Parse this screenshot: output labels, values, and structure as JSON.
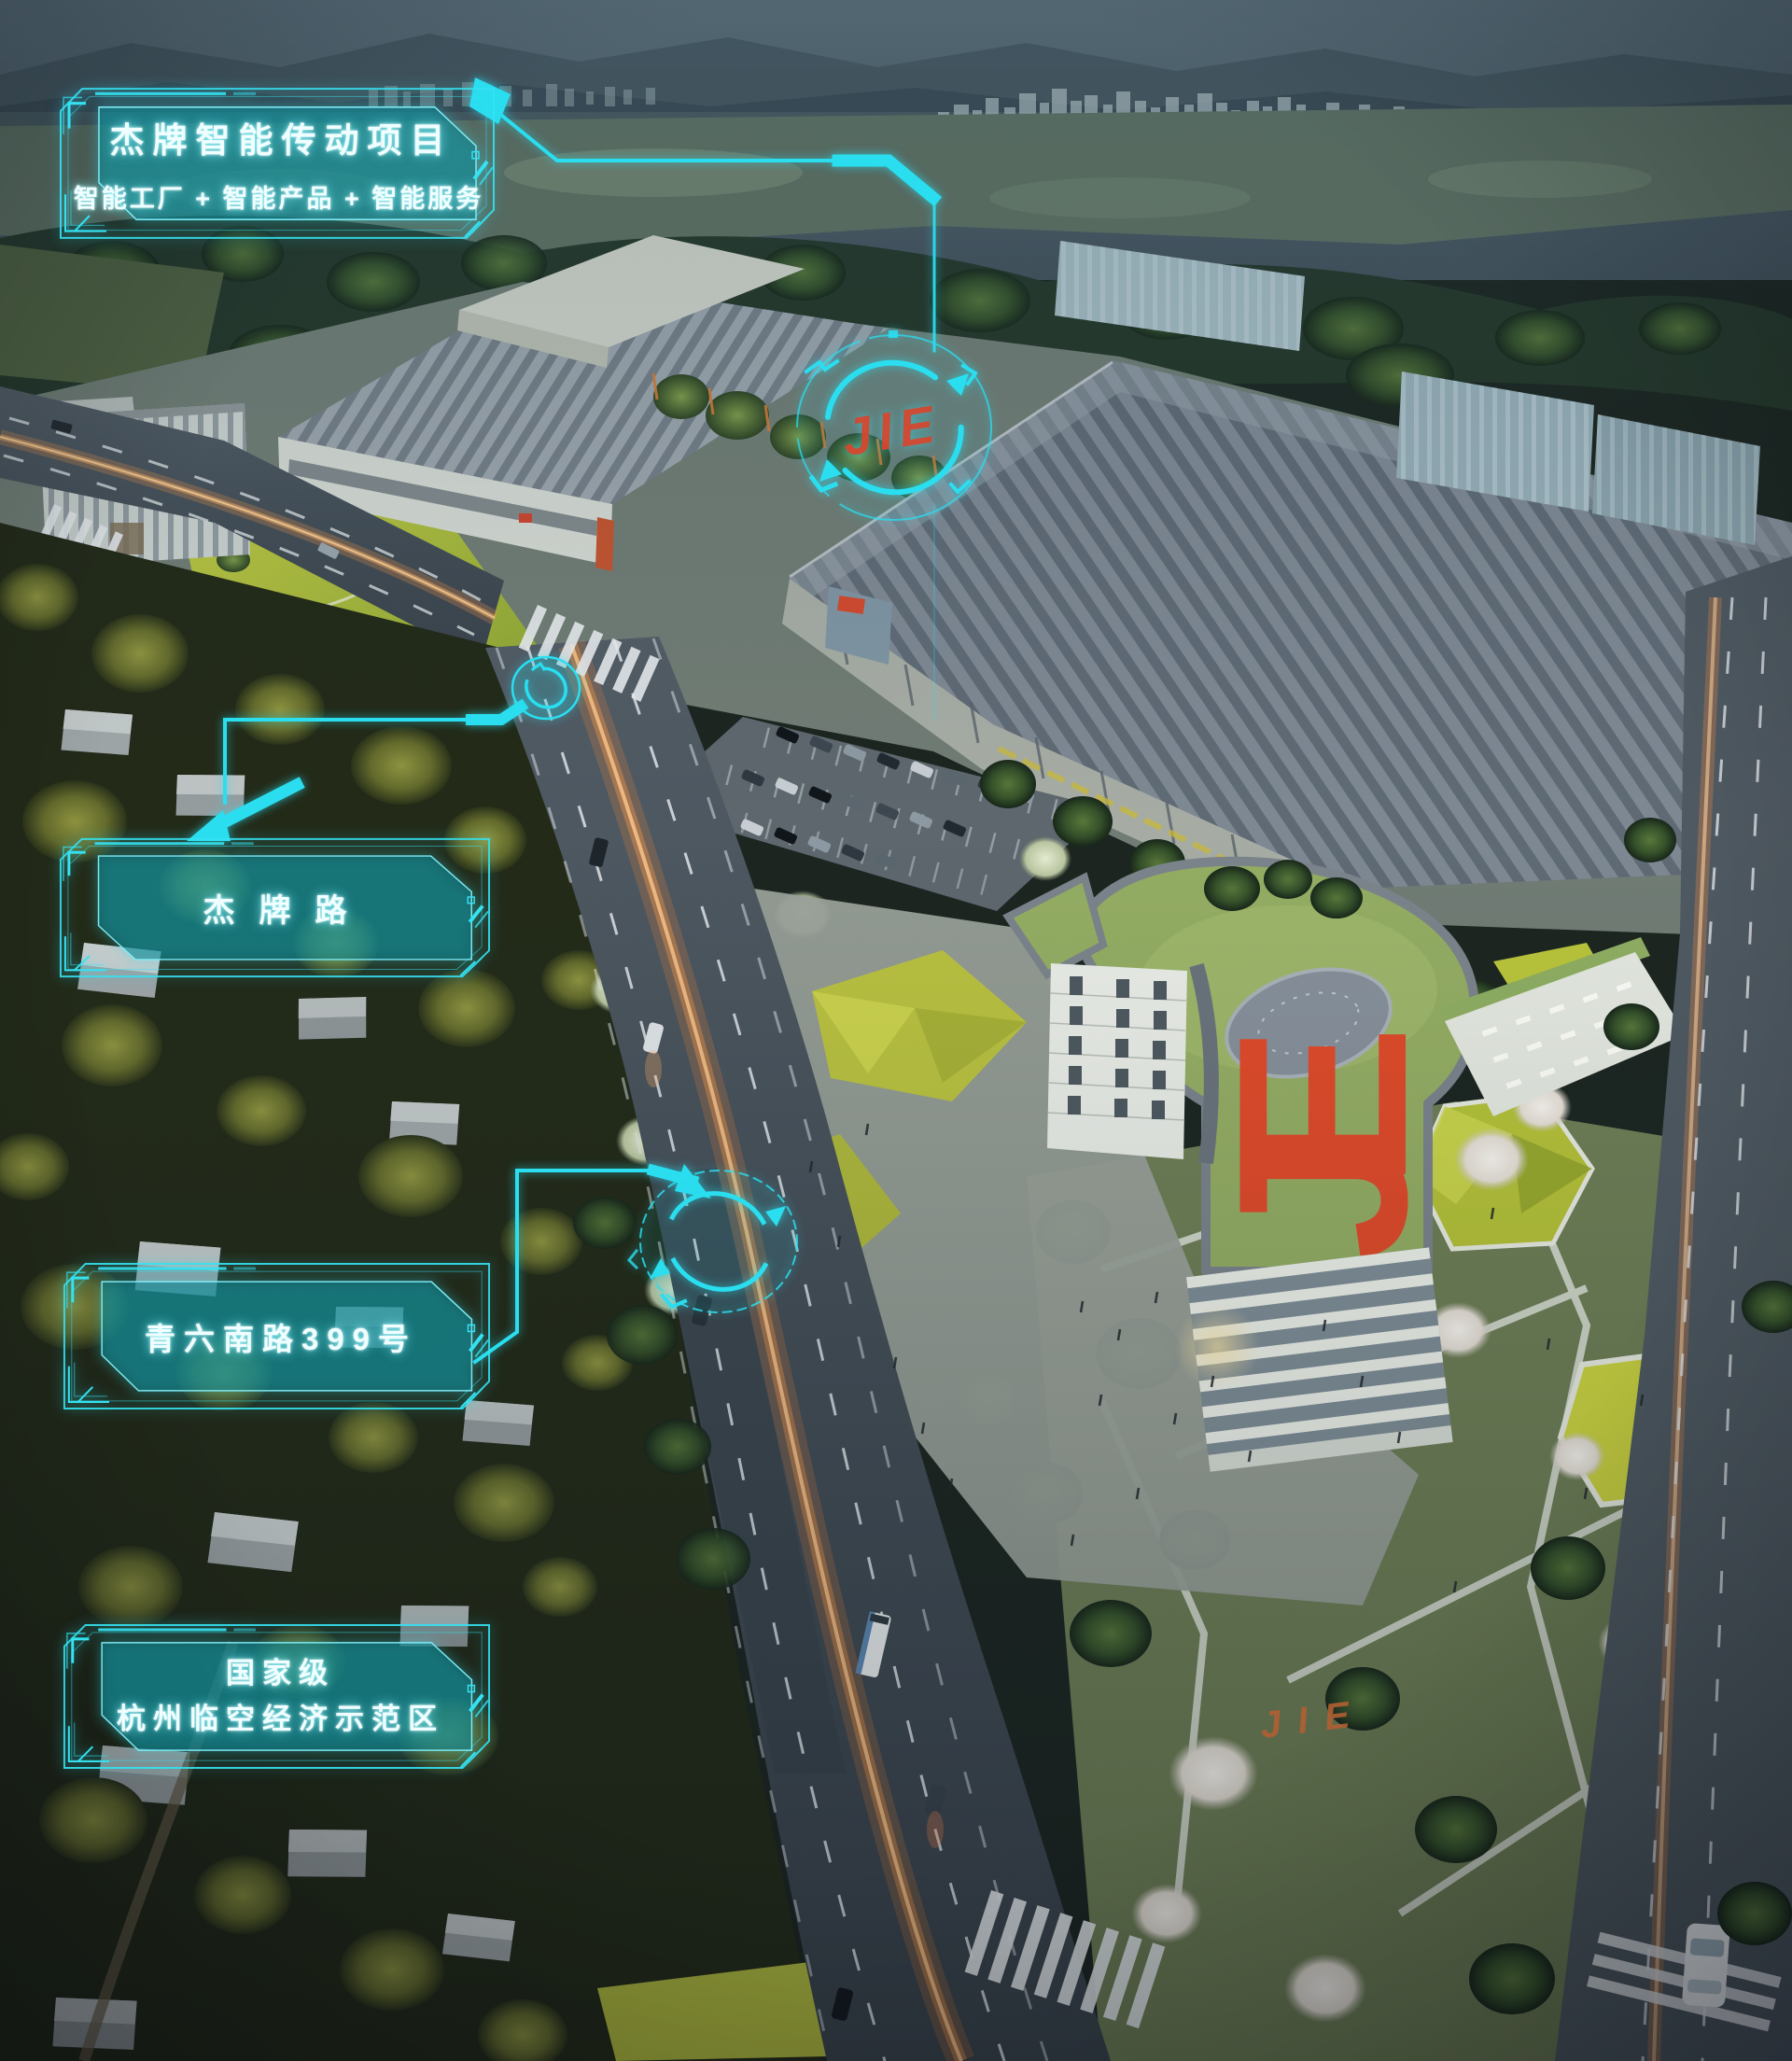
{
  "colors": {
    "accent_cyan": "#2BDEF0",
    "panel_teal": "#0E7C86",
    "logo_red": "#E04A2A",
    "lawn_logo_orange": "#DB7338",
    "road_glow_orange": "#FF9040"
  },
  "callouts": {
    "project": {
      "title": "杰牌智能传动项目",
      "subtitle": "智能工厂 + 智能产品 + 智能服务"
    },
    "road": {
      "label": "杰牌路"
    },
    "address": {
      "label": "青六南路399号"
    },
    "zone": {
      "line1": "国家级",
      "line2": "杭州临空经济示范区"
    }
  },
  "logos": {
    "hud_circle": "JIE",
    "roof": "JIE",
    "lawn": "JIE"
  }
}
